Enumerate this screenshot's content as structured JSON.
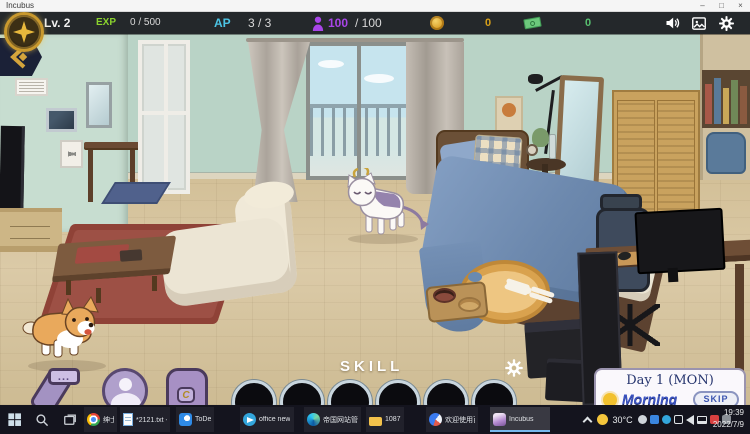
{
  "window": {
    "title": "Incubus",
    "minimize": "–",
    "maximize": "□",
    "close": "×"
  },
  "hud": {
    "level": "Lv. 2",
    "exp_label": "EXP",
    "exp_value": "0 / 500",
    "ap_label": "AP",
    "ap_value": "3 / 3",
    "spirit_current": "100",
    "spirit_max": "/ 100",
    "gold_value": "0",
    "cash_value": "0",
    "colors": {
      "exp_green": "#8ad22e",
      "ap_cyan": "#4cc4e4",
      "spirit_purple": "#a845e8",
      "gold": "#d8a018",
      "cash_green": "#58c070"
    }
  },
  "skill_bar": {
    "label": "SKILL",
    "slot_count": 6
  },
  "day_panel": {
    "title": "Day 1 (MON)",
    "period": "Morning",
    "skip_label": "SKIP"
  },
  "chat_bubble": "...",
  "backpack_emblem": "C",
  "taskbar": {
    "items": [
      {
        "icon": "chrome-icon",
        "label": "绅士游戏合集-绅士..."
      },
      {
        "icon": "notepad-icon",
        "label": "*2121.txt - 记事本"
      },
      {
        "icon": "todesk-icon",
        "label": "ToDesk"
      },
      {
        "icon": "telegram-icon",
        "label": "office new"
      },
      {
        "icon": "edge-icon",
        "label": "帝国网站管理系统..."
      },
      {
        "icon": "folder-icon",
        "label": "1087"
      },
      {
        "icon": "baidu-netdisk-icon",
        "label": "欢迎使用百度网盘"
      },
      {
        "icon": "incubus-icon",
        "label": "Incubus",
        "active": true
      }
    ],
    "tray": {
      "temperature": "30°C",
      "time": "19:39",
      "date": "2022/7/9"
    }
  }
}
